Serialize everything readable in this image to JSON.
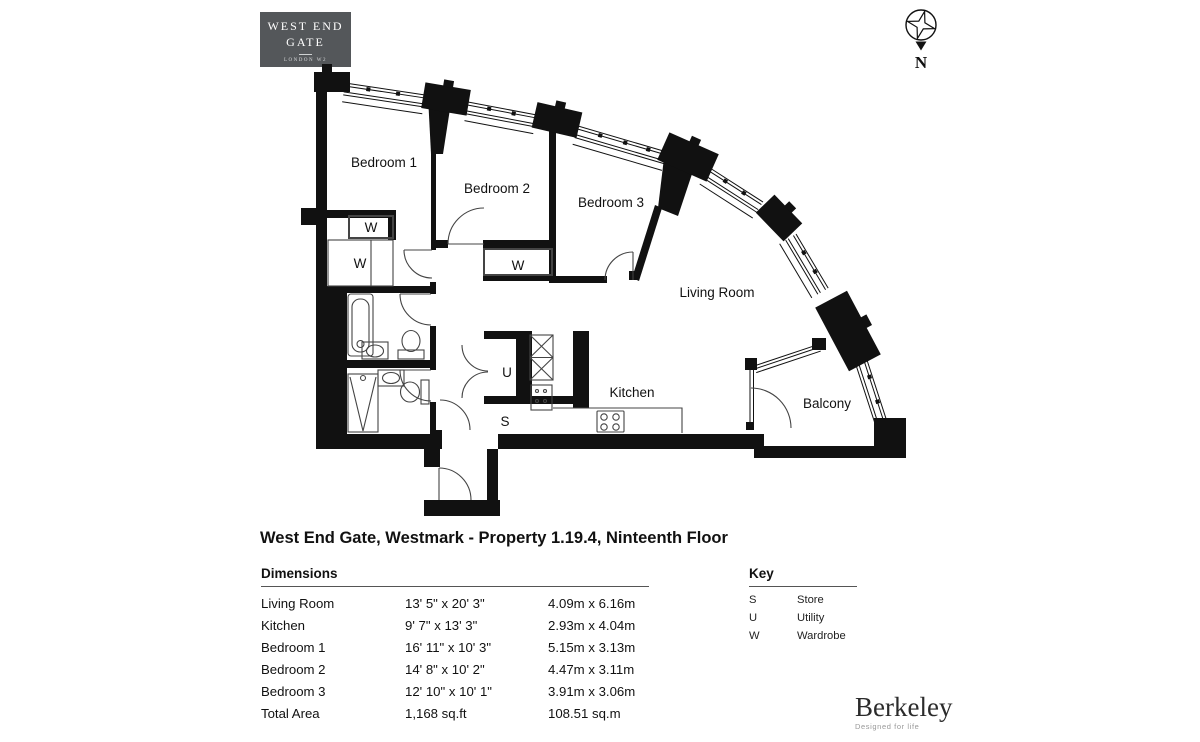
{
  "header": {
    "logo": {
      "line1": "WEST END",
      "line2": "GATE",
      "line3": "LONDON W2",
      "bg": "#54575A"
    },
    "compass": {
      "label": "N"
    }
  },
  "plan": {
    "labels": {
      "bedroom1": "Bedroom 1",
      "bedroom2": "Bedroom 2",
      "bedroom3": "Bedroom 3",
      "living_room": "Living Room",
      "kitchen": "Kitchen",
      "balcony": "Balcony",
      "wardrobe": "W",
      "utility": "U",
      "store": "S"
    }
  },
  "title": "West End Gate, Westmark - Property 1.19.4, Ninteenth Floor",
  "dimensions": {
    "heading": "Dimensions",
    "rows": [
      {
        "room": "Living Room",
        "imperial": "13' 5\" x 20' 3\"",
        "metric": "4.09m x 6.16m"
      },
      {
        "room": "Kitchen",
        "imperial": "9' 7\" x 13' 3\"",
        "metric": "2.93m x 4.04m"
      },
      {
        "room": "Bedroom 1",
        "imperial": "16' 11\" x 10' 3\"",
        "metric": "5.15m x 3.13m"
      },
      {
        "room": "Bedroom 2",
        "imperial": "14' 8\" x 10' 2\"",
        "metric": "4.47m x 3.11m"
      },
      {
        "room": "Bedroom 3",
        "imperial": "12' 10\" x 10' 1\"",
        "metric": "3.91m x 3.06m"
      },
      {
        "room": "Total Area",
        "imperial": "1,168 sq.ft",
        "metric": "108.51 sq.m"
      }
    ]
  },
  "key": {
    "heading": "Key",
    "rows": [
      {
        "abbr": "S",
        "label": "Store"
      },
      {
        "abbr": "U",
        "label": "Utility"
      },
      {
        "abbr": "W",
        "label": "Wardrobe"
      }
    ]
  },
  "footer": {
    "brand": "Berkeley",
    "tagline": "Designed for life"
  }
}
